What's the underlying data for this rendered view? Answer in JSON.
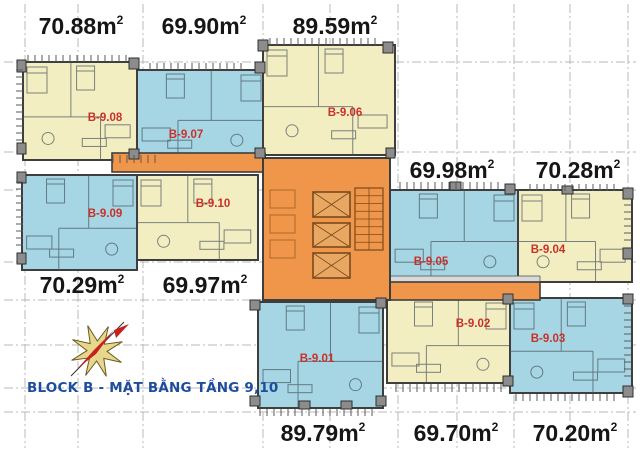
{
  "title": {
    "text": "BLOCK B - MẶT BẰNG TẦNG 9,10"
  },
  "icons": {
    "compass": "compass-rose-icon"
  },
  "colors": {
    "background": "#FFFFFF",
    "unit_yellow": "#F3EEC2",
    "unit_blue": "#A6D6E4",
    "core_orange": "#F0964B",
    "wall": "#3E3E3E",
    "unit_code_red": "#C8302A",
    "area_label_black": "#161616",
    "title_blue": "#1D4D9B",
    "grid_gray": "#B9B9B9",
    "column_fill": "#8C8C8C",
    "column_border": "#2F2F2F",
    "elevator_fill": "#E9A862",
    "elevator_border": "#7A4A1F",
    "furniture_gray": "#49565E",
    "hatch_gray": "#5A5A5A",
    "band_gray": "#D9D9D9",
    "compass_star": "#E6D78C",
    "compass_star_edge": "#6B5A1E",
    "compass_needle": "#C8201D"
  },
  "plan": {
    "width": 640,
    "height": 452,
    "area_unit_suffix": "m",
    "area_superscript": "2",
    "grid": {
      "vertical_x": [
        25,
        78,
        143,
        263,
        330,
        398,
        457,
        514,
        570,
        628
      ],
      "horizontal_y": [
        62,
        152,
        190,
        262,
        300,
        345,
        388,
        412
      ]
    },
    "units": [
      {
        "code": "B-9.08",
        "palette": "yellow",
        "rect": [
          23,
          62,
          114,
          98
        ],
        "label_at": [
          105,
          121
        ]
      },
      {
        "code": "B-9.07",
        "palette": "blue",
        "rect": [
          137,
          70,
          128,
          90
        ],
        "label_at": [
          186,
          138
        ]
      },
      {
        "code": "B-9.06",
        "palette": "yellow",
        "rect": [
          263,
          45,
          132,
          110
        ],
        "label_at": [
          345,
          116
        ]
      },
      {
        "code": "B-9.09",
        "palette": "blue",
        "rect": [
          22,
          175,
          115,
          95
        ],
        "label_at": [
          105,
          217
        ]
      },
      {
        "code": "B-9.10",
        "palette": "yellow",
        "rect": [
          137,
          175,
          121,
          85
        ],
        "label_at": [
          213,
          207
        ]
      },
      {
        "code": "B-9.05",
        "palette": "blue",
        "rect": [
          390,
          190,
          128,
          92
        ],
        "label_at": [
          431,
          265
        ]
      },
      {
        "code": "B-9.04",
        "palette": "yellow",
        "rect": [
          518,
          190,
          114,
          92
        ],
        "label_at": [
          548,
          253
        ]
      },
      {
        "code": "B-9.02",
        "palette": "yellow",
        "rect": [
          387,
          298,
          123,
          85
        ],
        "label_at": [
          473,
          327
        ]
      },
      {
        "code": "B-9.03",
        "palette": "blue",
        "rect": [
          510,
          298,
          122,
          95
        ],
        "label_at": [
          548,
          342
        ]
      },
      {
        "code": "B-9.01",
        "palette": "blue",
        "rect": [
          258,
          302,
          125,
          106
        ],
        "label_at": [
          317,
          362
        ]
      }
    ],
    "area_labels": [
      {
        "unit": "B-9.08",
        "text": "70.88",
        "at": [
          81,
          34
        ]
      },
      {
        "unit": "B-9.07",
        "text": "69.90",
        "at": [
          204,
          34
        ]
      },
      {
        "unit": "B-9.06",
        "text": "89.59",
        "at": [
          335,
          34
        ]
      },
      {
        "unit": "B-9.05",
        "text": "69.98",
        "at": [
          452,
          178
        ]
      },
      {
        "unit": "B-9.04",
        "text": "70.28",
        "at": [
          578,
          178
        ]
      },
      {
        "unit": "B-9.09",
        "text": "70.29",
        "at": [
          82,
          293
        ]
      },
      {
        "unit": "B-9.10",
        "text": "69.97",
        "at": [
          205,
          293
        ]
      },
      {
        "unit": "B-9.01",
        "text": "89.79",
        "at": [
          323,
          441
        ]
      },
      {
        "unit": "B-9.02",
        "text": "69.70",
        "at": [
          456,
          441
        ]
      },
      {
        "unit": "B-9.03",
        "text": "70.20",
        "at": [
          575,
          441
        ]
      }
    ],
    "core": {
      "rect": [
        263,
        158,
        127,
        142
      ]
    },
    "corridors": [
      [
        112,
        153,
        153,
        19
      ],
      [
        385,
        282,
        155,
        18
      ]
    ],
    "band": [
      385,
      276,
      155,
      6
    ],
    "elevators": [
      [
        313,
        192,
        37,
        25
      ],
      [
        313,
        223,
        37,
        24
      ],
      [
        313,
        253,
        37,
        25
      ]
    ],
    "stairs": {
      "rect": [
        355,
        188,
        28,
        62
      ],
      "treads": 8
    },
    "shafts": [
      [
        270,
        190,
        25,
        18
      ],
      [
        270,
        215,
        25,
        18
      ],
      [
        270,
        240,
        25,
        18
      ]
    ],
    "columns": [
      [
        17,
        60,
        9,
        12
      ],
      [
        17,
        143,
        9,
        11
      ],
      [
        17,
        172,
        9,
        11
      ],
      [
        17,
        253,
        9,
        11
      ],
      [
        129,
        58,
        10,
        11
      ],
      [
        129,
        149,
        10,
        10
      ],
      [
        255,
        62,
        10,
        11
      ],
      [
        255,
        148,
        10,
        10
      ],
      [
        258,
        40,
        10,
        11
      ],
      [
        383,
        42,
        10,
        11
      ],
      [
        386,
        148,
        9,
        10
      ],
      [
        450,
        182,
        11,
        8
      ],
      [
        505,
        184,
        10,
        10
      ],
      [
        562,
        186,
        11,
        8
      ],
      [
        623,
        188,
        10,
        11
      ],
      [
        623,
        248,
        9,
        11
      ],
      [
        623,
        294,
        10,
        10
      ],
      [
        623,
        386,
        10,
        11
      ],
      [
        503,
        294,
        10,
        10
      ],
      [
        503,
        376,
        10,
        10
      ],
      [
        376,
        298,
        10,
        10
      ],
      [
        376,
        396,
        10,
        10
      ],
      [
        250,
        300,
        10,
        10
      ],
      [
        250,
        396,
        10,
        10
      ],
      [
        299,
        401,
        11,
        8
      ],
      [
        341,
        401,
        11,
        8
      ]
    ],
    "hatches": [
      [
        28,
        55,
        100,
        7,
        "h"
      ],
      [
        150,
        63,
        95,
        7,
        "h"
      ],
      [
        270,
        38,
        110,
        7,
        "h"
      ],
      [
        400,
        182,
        100,
        7,
        "h"
      ],
      [
        530,
        184,
        90,
        7,
        "h"
      ],
      [
        396,
        384,
        106,
        8,
        "h"
      ],
      [
        516,
        394,
        104,
        7,
        "h"
      ],
      [
        260,
        409,
        118,
        7,
        "h"
      ],
      [
        16,
        70,
        7,
        70,
        "v"
      ],
      [
        16,
        182,
        7,
        68,
        "v"
      ],
      [
        624,
        205,
        7,
        40,
        "v"
      ],
      [
        624,
        306,
        7,
        75,
        "v"
      ],
      [
        113,
        155,
        48,
        8,
        "h"
      ]
    ]
  }
}
